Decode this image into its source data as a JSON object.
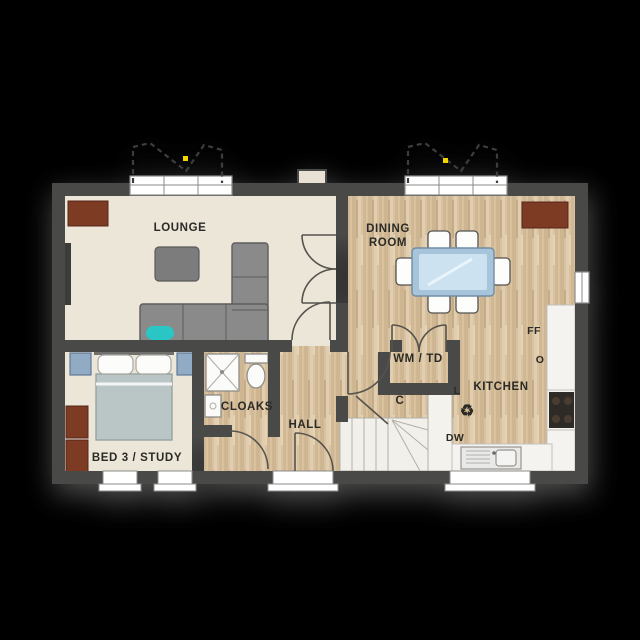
{
  "plan": {
    "type": "floorplan",
    "floor": "ground-floor",
    "background_color": "#000000",
    "colors": {
      "wall": "#4a4947",
      "cream_floor": "#ece6d8",
      "wood_floor": "#d8c2a2",
      "wood_grain_dark": "#cab08a",
      "wood_grain_light": "#e2ceb0",
      "stairs_floor": "#f2f0ea",
      "counter": "#f4f3f0",
      "sofa_gray": "#8a8a8a",
      "table_gray": "#7b7b7b",
      "sideboard_brown": "#7c3a22",
      "bed_duvet": "#b9c6c5",
      "bedside_blue": "#92abc5",
      "dining_table_rim": "#a8c4da",
      "dining_table_top": "#cde2f1",
      "accent_teal": "#2cc5c5",
      "hob_black": "#2e2a27",
      "marker_yellow": "#f5d400",
      "window_white": "#ffffff"
    }
  },
  "rooms": [
    {
      "id": "lounge",
      "label": "LOUNGE",
      "furniture": [
        "sideboard",
        "coffee-table",
        "corner-sofa",
        "teal-cushion",
        "radiator"
      ]
    },
    {
      "id": "dining",
      "label": "DINING ROOM",
      "label_lines": [
        "DINING",
        "ROOM"
      ],
      "furniture": [
        "dining-table",
        "six-chairs",
        "sideboard"
      ]
    },
    {
      "id": "kitchen",
      "label": "KITCHEN",
      "furniture": [
        "worktop",
        "sink",
        "hob"
      ]
    },
    {
      "id": "hall",
      "label": "HALL",
      "furniture": [
        "front-door",
        "stairs"
      ]
    },
    {
      "id": "cloaks",
      "label": "CLOAKS",
      "furniture": [
        "shower",
        "basin",
        "wc"
      ]
    },
    {
      "id": "bed3",
      "label": "BED 3 / STUDY",
      "furniture": [
        "double-bed",
        "bedside-tables",
        "wardrobe"
      ]
    },
    {
      "id": "utility",
      "label": "WM / TD"
    },
    {
      "id": "cupboard",
      "label": "C"
    }
  ],
  "appliances": [
    {
      "id": "fridge-freezer",
      "label": "FF"
    },
    {
      "id": "oven",
      "label": "O"
    },
    {
      "id": "larder",
      "label": "L"
    },
    {
      "id": "dishwasher",
      "label": "DW"
    },
    {
      "id": "recycling",
      "symbol": "♻"
    }
  ],
  "markers": {
    "bay_canopy_dots": 2,
    "dot_color": "#f5d400"
  }
}
